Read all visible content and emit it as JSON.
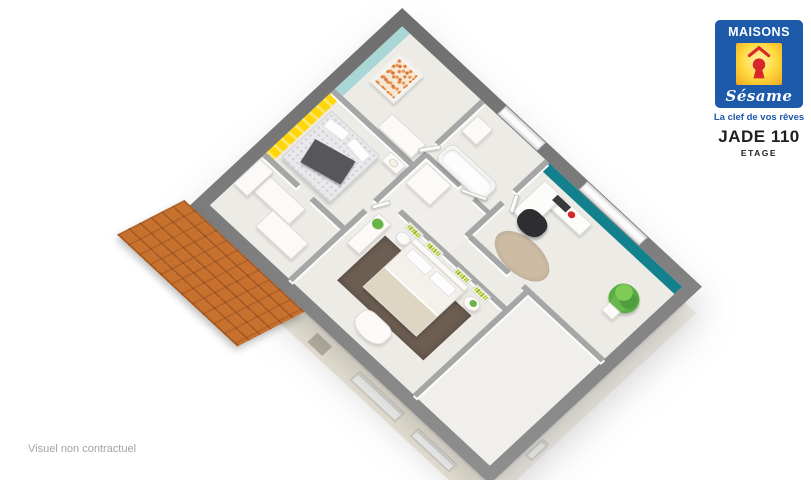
{
  "branding": {
    "name": "MAISONS",
    "script_name": "Sésame",
    "tagline": "La clef de vos rêves",
    "logo_icon": "keyhole-under-roof"
  },
  "header": {
    "title": "JADE 110",
    "subtitle": "ETAGE"
  },
  "footer": {
    "disclaimer": "Visuel non contractuel"
  },
  "colors": {
    "brand_blue": "#1d5aa9",
    "brand_yellow": "#ffd43c",
    "brand_red": "#d8262b",
    "teal_light": "#a9d7d6",
    "teal_dark": "#13808e",
    "accent_yellow": "#ffd60a",
    "roof_orange": "#c8702e",
    "slab_gray": "#7a7a7a",
    "floor": "#edebe6",
    "facade": "#f0ebdc"
  },
  "floorplan": {
    "view": "3d-isometric-cutaway-upper-floor",
    "rooms": [
      {
        "id": "nursery",
        "accent_wall": "teal-light",
        "furniture": [
          "crib",
          "wardrobe"
        ]
      },
      {
        "id": "bathroom",
        "furniture": [
          "bathtub",
          "washbasin",
          "window"
        ]
      },
      {
        "id": "office",
        "accent_wall": "teal-dark",
        "furniture": [
          "corner-desk",
          "office-chair",
          "plant",
          "round-rug",
          "window-with-blinds"
        ]
      },
      {
        "id": "bedroom-yellow",
        "accent_wall": "yellow-stripes",
        "furniture": [
          "double-bed",
          "dark-throw",
          "nightstand-with-lamp",
          "wardrobe"
        ]
      },
      {
        "id": "master-bedroom",
        "furniture": [
          "double-bed",
          "headboard-shelves-green-books",
          "round-nightstands",
          "brown-rug",
          "armchair",
          "dresser-with-plant"
        ]
      },
      {
        "id": "landing",
        "furniture": [
          "doors",
          "closets"
        ]
      }
    ],
    "exterior": [
      "gray-wall-caps",
      "cream-facade",
      "facade-windows",
      "orange-tiled-roof"
    ]
  }
}
